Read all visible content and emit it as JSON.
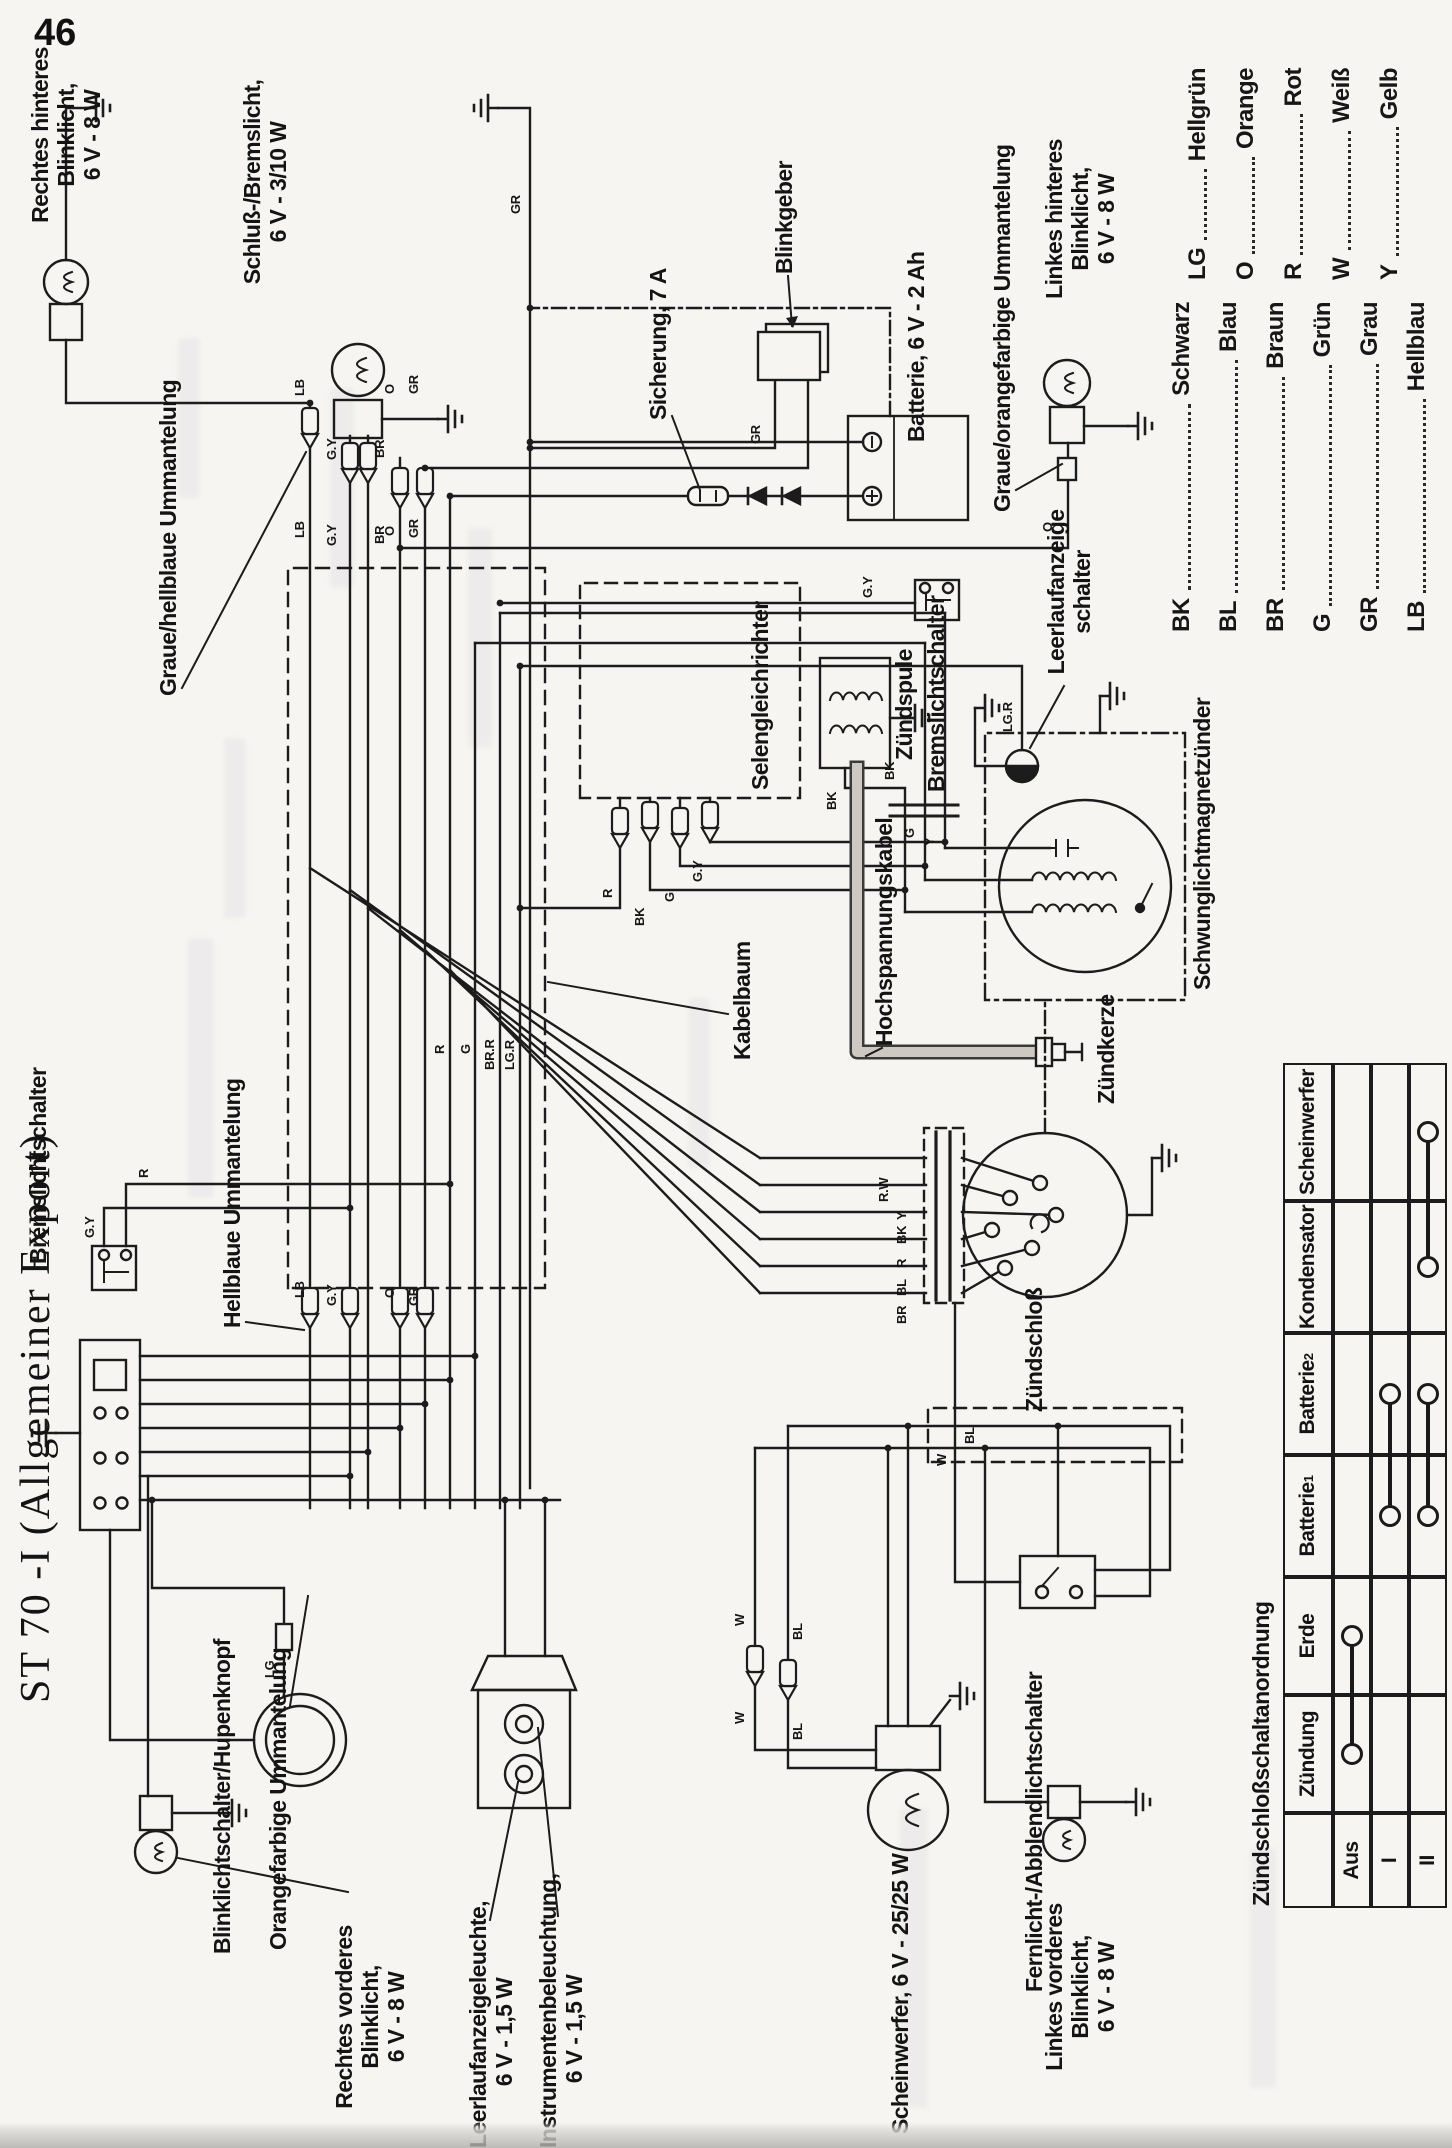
{
  "page_number": "46",
  "title": "ST 70 -I (Allgemeiner Export)",
  "diagram": {
    "labels": [
      {
        "id": "label-rechtes-hinteres-blinklicht",
        "x": 1884,
        "y": 28,
        "w": 258,
        "align": "c",
        "lines": [
          "Rechtes hinteres Blinklicht,",
          "6 V - 8 W"
        ]
      },
      {
        "id": "label-schluss-bremslicht",
        "x": 1850,
        "y": 240,
        "w": 232,
        "align": "c",
        "lines": [
          "Schluß-/Bremslicht,",
          "6 V - 3/10 W"
        ]
      },
      {
        "id": "label-graue-hellblaue-ummantelung",
        "x": 1452,
        "y": 156,
        "lines": [
          "Graue/hellblaue Ummantelung"
        ]
      },
      {
        "id": "label-sicherung",
        "x": 1728,
        "y": 646,
        "lines": [
          "Sicherung, 7 A"
        ]
      },
      {
        "id": "label-blinkgeber",
        "x": 1874,
        "y": 772,
        "lines": [
          "Blinkgeber"
        ]
      },
      {
        "id": "label-batterie",
        "x": 1706,
        "y": 904,
        "lines": [
          "Batterie, 6 V - 2 Ah"
        ]
      },
      {
        "id": "label-graue-orangefarbige-ummantelung",
        "x": 1636,
        "y": 990,
        "lines": [
          "Graue/orangefarbige Ummantelung"
        ]
      },
      {
        "id": "label-linkes-hinteres-blinklicht",
        "x": 1798,
        "y": 1042,
        "w": 262,
        "align": "c",
        "lines": [
          "Linkes hinteres Blinklicht,",
          "6 V - 8 W"
        ]
      },
      {
        "id": "label-selengleichrichter",
        "x": 1358,
        "y": 748,
        "lines": [
          "Selengleichrichter"
        ]
      },
      {
        "id": "label-zundspule",
        "x": 1388,
        "y": 892,
        "lines": [
          "Zündspule"
        ]
      },
      {
        "id": "label-bremslichtschalter-hinten",
        "x": 1356,
        "y": 924,
        "lines": [
          "Bremslichtschalter"
        ]
      },
      {
        "id": "label-leerlaufanzeigeschalter",
        "x": 1458,
        "y": 1044,
        "w": 196,
        "align": "c",
        "lines": [
          "Leerlaufanzeige",
          "schalter"
        ]
      },
      {
        "id": "label-schwunglichtmagnetzunder",
        "x": 1158,
        "y": 1190,
        "lines": [
          "Schwunglichtmagnetzünder"
        ]
      },
      {
        "id": "label-kabelbaum",
        "x": 1088,
        "y": 730,
        "lines": [
          "Kabelbaum"
        ]
      },
      {
        "id": "label-hochspannungskabel",
        "x": 1102,
        "y": 872,
        "lines": [
          "Hochspannungskabel"
        ]
      },
      {
        "id": "label-zundkerze",
        "x": 1044,
        "y": 1094,
        "lines": [
          "Zündkerze"
        ]
      },
      {
        "id": "label-zundschloss",
        "x": 736,
        "y": 1022,
        "lines": [
          "Zündschloß"
        ]
      },
      {
        "id": "label-hellblaue-ummantelung",
        "x": 820,
        "y": 220,
        "lines": [
          "Hellblaue Ummantelung"
        ]
      },
      {
        "id": "label-bremslichtschalter-vorn",
        "x": 884,
        "y": 26,
        "lines": [
          "Bremslichtschalter"
        ]
      },
      {
        "id": "label-blinklichtschalter-hupenknopf",
        "x": 194,
        "y": 210,
        "lines": [
          "Blinklichtschalter/Hupenknopf"
        ]
      },
      {
        "id": "label-orangefarbige-ummantelung",
        "x": 198,
        "y": 266,
        "lines": [
          "Orangefarbige Ummantelung"
        ]
      },
      {
        "id": "label-rechtes-vorderes-blinklicht",
        "x": 2,
        "y": 332,
        "w": 258,
        "align": "c",
        "lines": [
          "Rechtes vorderes Blinklicht,",
          "6 V - 8 W"
        ]
      },
      {
        "id": "label-leerlaufanzeigeleuchte",
        "x": 0,
        "y": 466,
        "w": 232,
        "align": "c",
        "lines": [
          "Leerlaufanzeigeleuchte,",
          "6 V - 1,5 W"
        ]
      },
      {
        "id": "label-instrumentenbeleuchtung",
        "x": 0,
        "y": 536,
        "w": 238,
        "align": "c",
        "lines": [
          "Instrumentenbeleuchtung,",
          "6 V - 1,5 W"
        ]
      },
      {
        "id": "label-scheinwerfer",
        "x": 14,
        "y": 888,
        "lines": [
          "Scheinwerfer, 6 V - 25/25 W"
        ]
      },
      {
        "id": "label-fernlicht-abblendlichtschalter",
        "x": 156,
        "y": 1022,
        "lines": [
          "Fernlicht-/Abblendlichtschalter"
        ]
      },
      {
        "id": "label-linkes-vorderes-blinklicht",
        "x": 32,
        "y": 1042,
        "w": 258,
        "align": "c",
        "lines": [
          "Linkes vorderes Blinklicht,",
          "6 V - 8 W"
        ]
      }
    ],
    "wire_labels": [
      {
        "t": "LB",
        "x": 1752,
        "y": 292
      },
      {
        "t": "G.Y",
        "x": 1688,
        "y": 324
      },
      {
        "t": "BR",
        "x": 1690,
        "y": 372
      },
      {
        "t": "O",
        "x": 1754,
        "y": 382
      },
      {
        "t": "GR",
        "x": 1754,
        "y": 406
      },
      {
        "t": "LB",
        "x": 1610,
        "y": 292
      },
      {
        "t": "G.Y",
        "x": 1602,
        "y": 324
      },
      {
        "t": "BR",
        "x": 1604,
        "y": 372
      },
      {
        "t": "O",
        "x": 1612,
        "y": 382
      },
      {
        "t": "GR",
        "x": 1610,
        "y": 406
      },
      {
        "t": "LB",
        "x": 850,
        "y": 292
      },
      {
        "t": "G.Y",
        "x": 842,
        "y": 324
      },
      {
        "t": "O",
        "x": 850,
        "y": 382
      },
      {
        "t": "GR",
        "x": 842,
        "y": 406
      },
      {
        "t": "R",
        "x": 1094,
        "y": 432
      },
      {
        "t": "G",
        "x": 1094,
        "y": 458
      },
      {
        "t": "BR.R",
        "x": 1078,
        "y": 482
      },
      {
        "t": "LG.R",
        "x": 1078,
        "y": 502
      },
      {
        "t": "G.Y",
        "x": 910,
        "y": 82
      },
      {
        "t": "R",
        "x": 970,
        "y": 136
      },
      {
        "t": "LG",
        "x": 470,
        "y": 262
      },
      {
        "t": "W",
        "x": 424,
        "y": 732
      },
      {
        "t": "BL",
        "x": 408,
        "y": 790
      },
      {
        "t": "W",
        "x": 522,
        "y": 732
      },
      {
        "t": "BL",
        "x": 508,
        "y": 790
      },
      {
        "t": "W",
        "x": 682,
        "y": 934
      },
      {
        "t": "BL",
        "x": 704,
        "y": 962
      },
      {
        "t": "R",
        "x": 1250,
        "y": 600
      },
      {
        "t": "BK",
        "x": 1222,
        "y": 632
      },
      {
        "t": "G",
        "x": 1246,
        "y": 662
      },
      {
        "t": "G.Y",
        "x": 1266,
        "y": 690
      },
      {
        "t": "BK",
        "x": 1338,
        "y": 824
      },
      {
        "t": "G.Y",
        "x": 1550,
        "y": 860
      },
      {
        "t": "BK",
        "x": 1368,
        "y": 882
      },
      {
        "t": "G",
        "x": 1310,
        "y": 902
      },
      {
        "t": "Y",
        "x": 1302,
        "y": 922
      },
      {
        "t": "LG.R",
        "x": 1416,
        "y": 1000
      },
      {
        "t": "BR",
        "x": 824,
        "y": 894
      },
      {
        "t": "BL",
        "x": 852,
        "y": 894
      },
      {
        "t": "R",
        "x": 880,
        "y": 894
      },
      {
        "t": "BK",
        "x": 904,
        "y": 894
      },
      {
        "t": "Y",
        "x": 928,
        "y": 894
      },
      {
        "t": "R.W",
        "x": 946,
        "y": 876
      },
      {
        "t": "GR",
        "x": 1934,
        "y": 508
      },
      {
        "t": "O",
        "x": 1616,
        "y": 1040
      },
      {
        "t": "GR",
        "x": 1704,
        "y": 748
      }
    ]
  },
  "legend": {
    "left": [
      {
        "code": "BK",
        "name": "Schwarz"
      },
      {
        "code": "BL",
        "name": "Blau"
      },
      {
        "code": "BR",
        "name": "Braun"
      },
      {
        "code": "G",
        "name": "Grün"
      },
      {
        "code": "GR",
        "name": "Grau"
      },
      {
        "code": "LB",
        "name": "Hellblau"
      }
    ],
    "right": [
      {
        "code": "LG",
        "name": "Hellgrün"
      },
      {
        "code": "O",
        "name": "Orange"
      },
      {
        "code": "R",
        "name": "Rot"
      },
      {
        "code": "W",
        "name": "Weiß"
      },
      {
        "code": "Y",
        "name": "Gelb"
      }
    ]
  },
  "table": {
    "title": "Zündschloßschaltanordnung",
    "row_labels": [
      "Aus",
      "I",
      "II"
    ],
    "columns": [
      {
        "label": "Zündung",
        "sub": ""
      },
      {
        "label": "Erde",
        "sub": ""
      },
      {
        "label": "Batterie",
        "sub": "1"
      },
      {
        "label": "Batterie",
        "sub": "2"
      },
      {
        "label": "Kondensator",
        "sub": ""
      },
      {
        "label": "Scheinwerfer",
        "sub": ""
      }
    ],
    "connections": [
      {
        "row": 0,
        "cols": [
          0,
          1
        ]
      },
      {
        "row": 1,
        "cols": [
          2,
          3
        ]
      },
      {
        "row": 2,
        "cols": [
          2,
          3
        ]
      },
      {
        "row": 2,
        "cols": [
          4,
          5
        ]
      }
    ]
  }
}
